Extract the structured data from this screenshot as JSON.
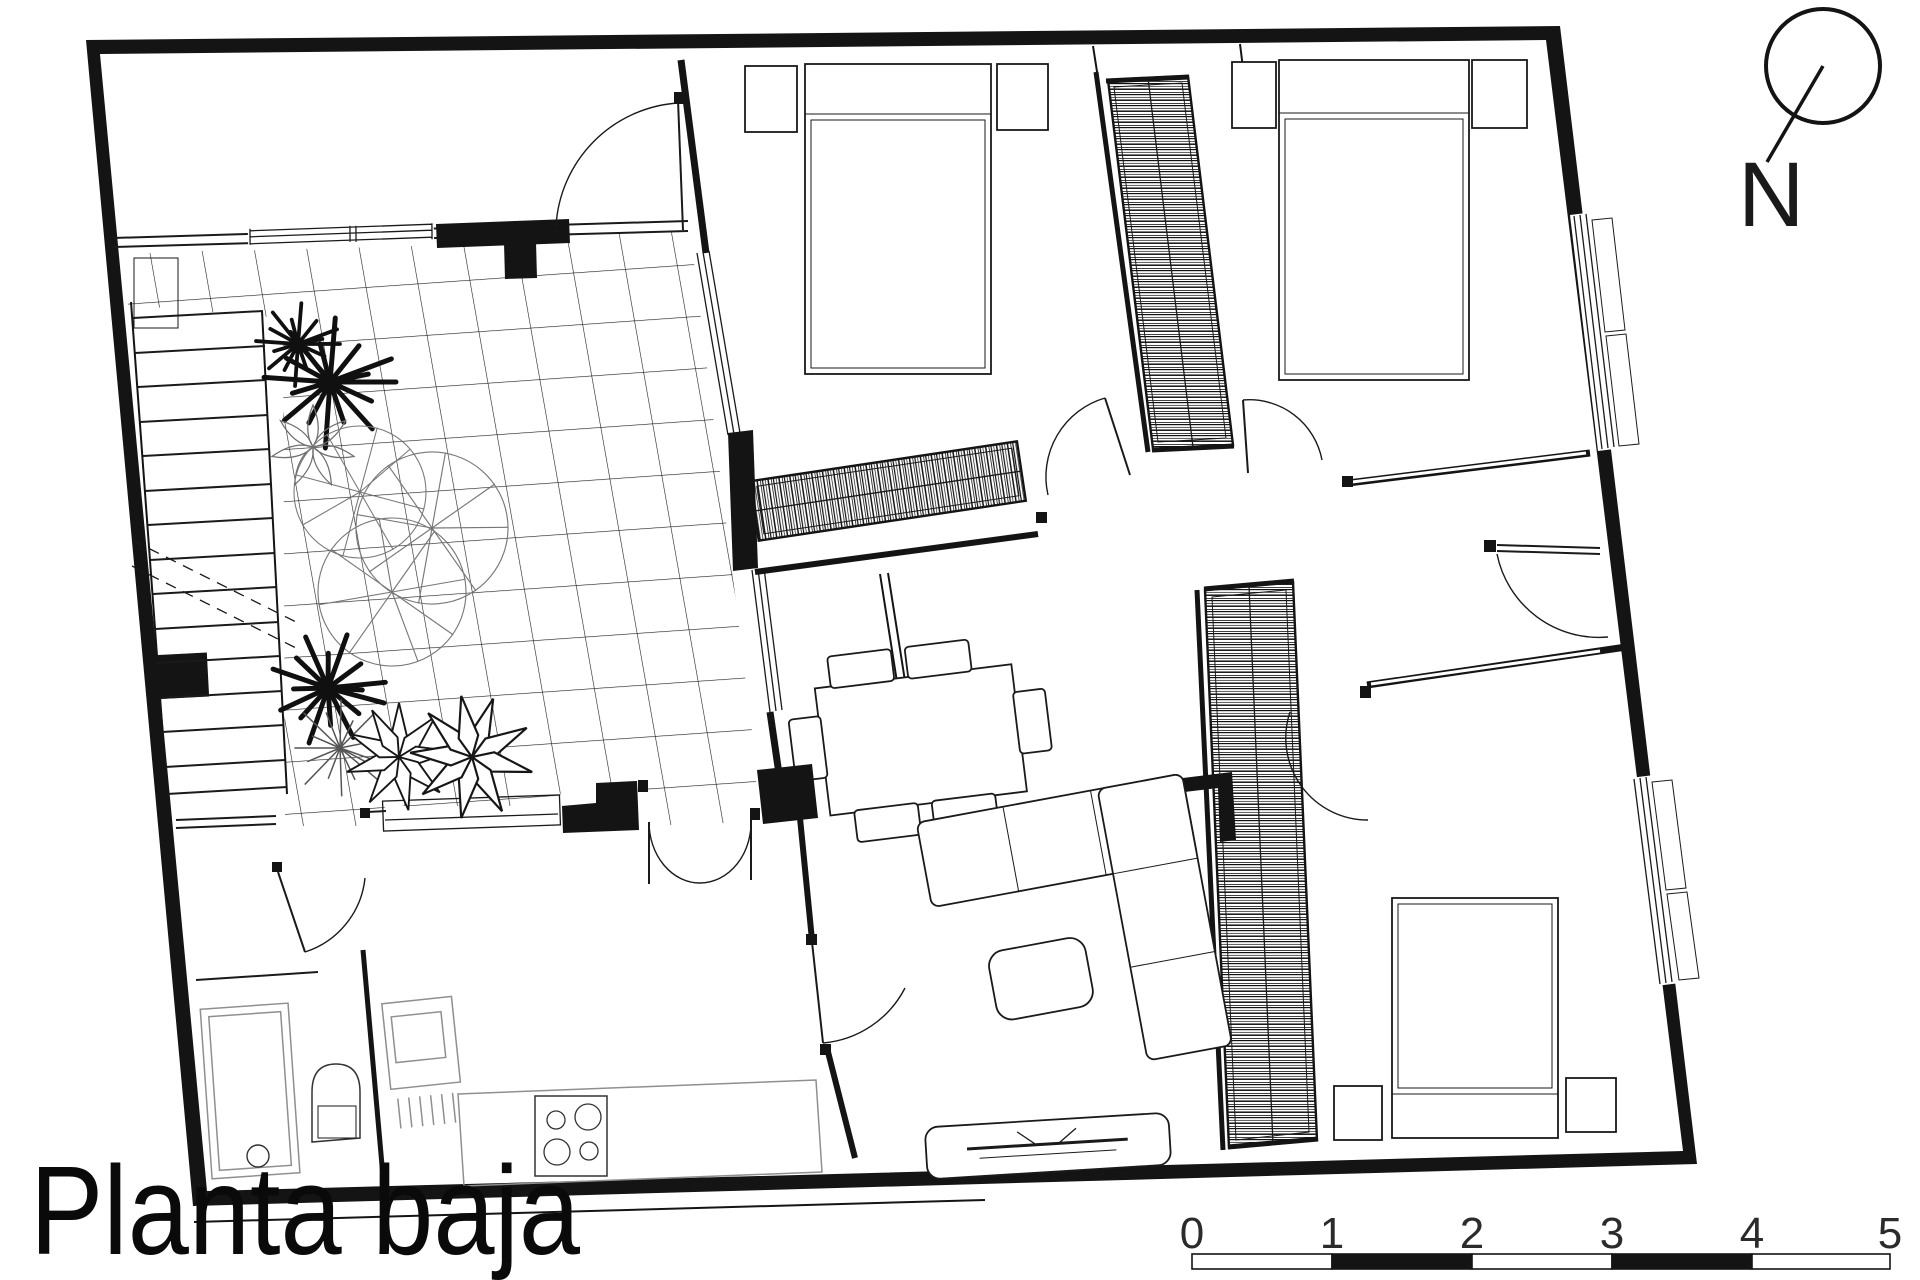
{
  "document": {
    "title": "Planta baja",
    "north_label": "N",
    "scale_labels": [
      "0",
      "1",
      "2",
      "3",
      "4",
      "5"
    ],
    "colors": {
      "ink": "#141414",
      "gray": "#8f8f8f",
      "paper": "#ffffff"
    }
  }
}
